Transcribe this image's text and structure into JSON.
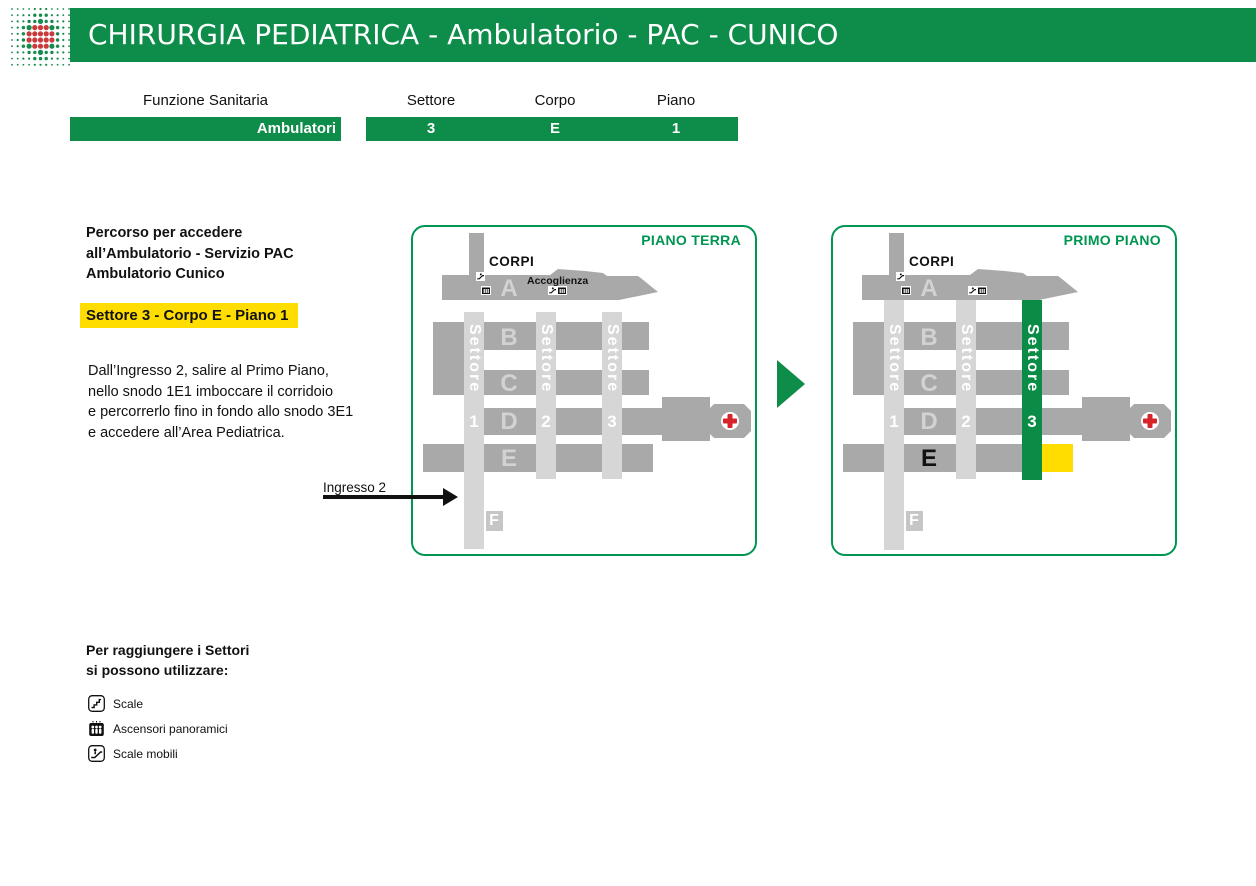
{
  "colors": {
    "brand_green": "#0d8c4a",
    "map_title_green": "#009551",
    "sector3_green": "#0b8c46",
    "highlight_yellow": "#ffdd00",
    "block_gray": "#a9a9a9",
    "strip_gray": "#d6d6d6",
    "f_block_gray": "#c6c6c6",
    "letter_gray": "#d2d2d2",
    "cross_red": "#d8232a",
    "logo_green": "#178a4e",
    "logo_red": "#c93b3d"
  },
  "header": {
    "title": "CHIRURGIA PEDIATRICA - Ambulatorio - PAC - CUNICO"
  },
  "info_table": {
    "function_header": "Funzione Sanitaria",
    "function_value": "Ambulatori",
    "sector_header": "Settore",
    "sector_value": "3",
    "body_header": "Corpo",
    "body_value": "E",
    "floor_header": "Piano",
    "floor_value": "1"
  },
  "route": {
    "intro_lines": [
      "Percorso per accedere",
      "all’Ambulatorio - Servizio PAC",
      "Ambulatorio Cunico"
    ],
    "highlight": "Settore 3 - Corpo E - Piano 1",
    "description_lines": [
      "Dall’Ingresso 2, salire al Primo Piano,",
      "nello snodo 1E1 imboccare il corridoio",
      "e percorrerlo fino in fondo allo snodo 3E1",
      "e accedere all’Area Pediatrica."
    ],
    "entrance_label": "Ingresso 2"
  },
  "maps": {
    "left": {
      "title": "PIANO TERRA",
      "corpi": "CORPI",
      "accoglienza": "Accoglienza",
      "letters": [
        "A",
        "B",
        "C",
        "D",
        "E",
        "F"
      ],
      "sector_word": "Settore",
      "sector_numbers": [
        "1",
        "2",
        "3"
      ]
    },
    "right": {
      "title": "PRIMO PIANO",
      "corpi": "CORPI",
      "letters": [
        "A",
        "B",
        "C",
        "D",
        "E",
        "F"
      ],
      "sector_word": "Settore",
      "sector_numbers": [
        "1",
        "2",
        "3"
      ]
    }
  },
  "legend": {
    "heading_lines": [
      "Per raggiungere i Settori",
      "si possono utilizzare:"
    ],
    "items": [
      {
        "icon": "stairs-icon",
        "label": "Scale"
      },
      {
        "icon": "panoramic-elevator-icon",
        "label": "Ascensori panoramici"
      },
      {
        "icon": "escalator-icon",
        "label": "Scale mobili"
      }
    ]
  }
}
